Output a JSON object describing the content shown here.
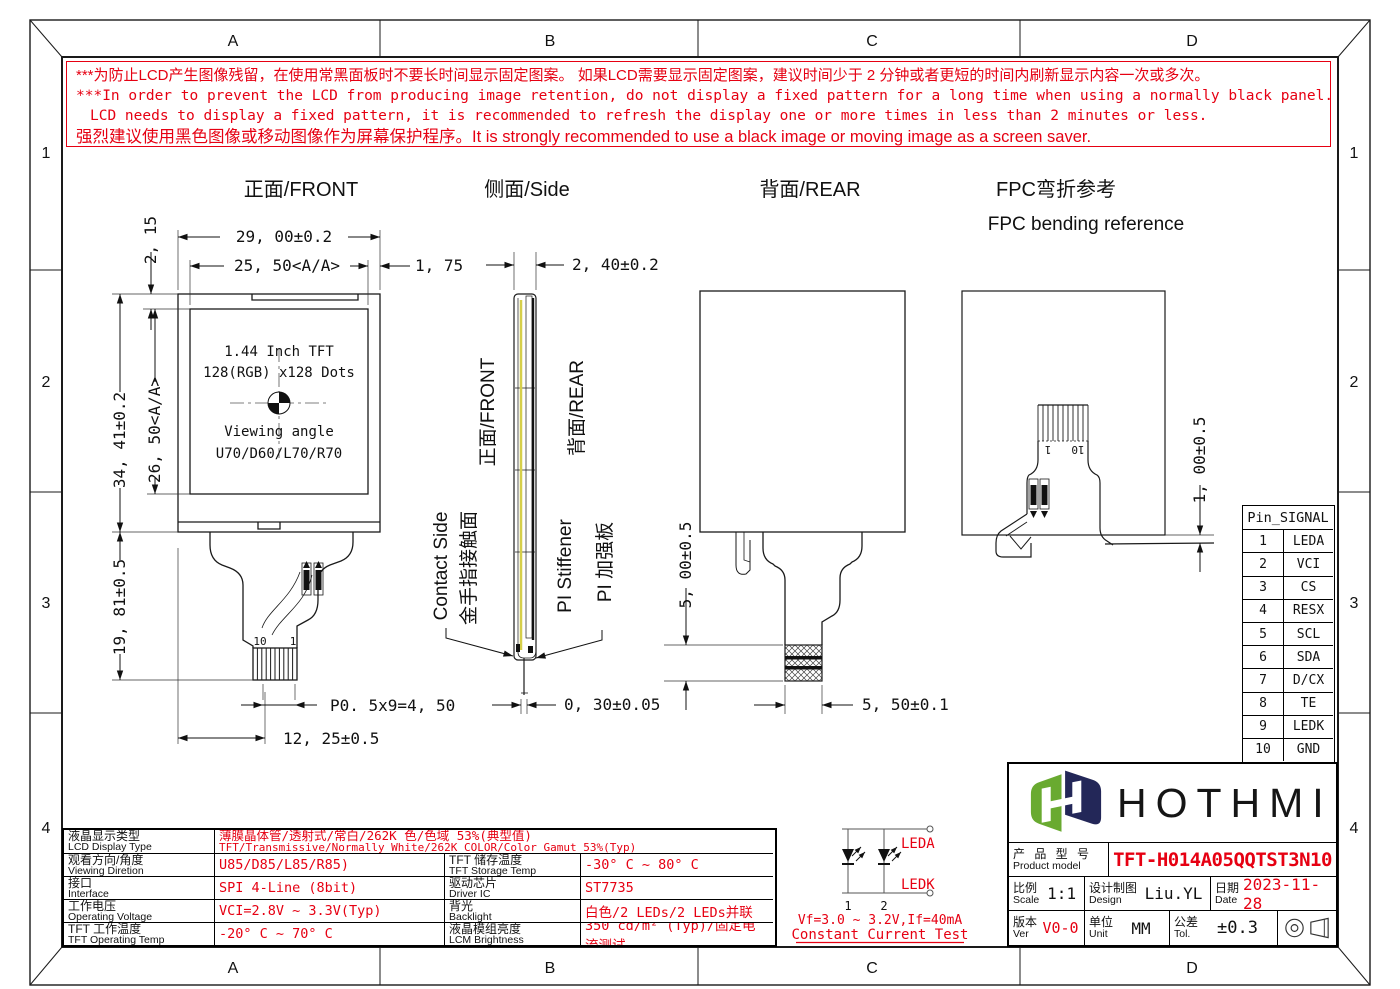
{
  "colors": {
    "accent_red": "#e60012",
    "film_yellow": "#d6cf4a",
    "logo_green": "#69aa30",
    "logo_navy": "#232758"
  },
  "sheet": {
    "cols": [
      "A",
      "B",
      "C",
      "D"
    ],
    "rows": [
      "1",
      "2",
      "3",
      "4"
    ]
  },
  "warning": {
    "line1": "***为防止LCD产生图像残留，在使用常黑面板时不要长时间显示固定图案。 如果LCD需要显示固定图案，建议时间少于 2 分钟或者更短的时间内刷新显示内容一次或多次。",
    "line2": "***In order to prevent the LCD from producing image retention, do not display a fixed pattern for a long time when using a normally black panel.If the",
    "line3": "LCD needs to display a fixed pattern, it is recommended to refresh the display one or more times in less than 2 minutes or less.",
    "line4": "强烈建议使用黑色图像或移动图像作为屏幕保护程序。It is strongly recommended to use a black image or moving image as a screen saver."
  },
  "front": {
    "title": "正面/FRONT",
    "dim_w": "29, 00±0.2",
    "dim_aa_w": "25, 50<A/A>",
    "dim_right": "1, 75",
    "dim_top": "2, 15",
    "dim_h": "34, 41±0.2",
    "dim_aa_h": "26, 50<A/A>",
    "dim_tail": "19, 81±0.5",
    "dim_pitch": "P0. 5x9=4, 50",
    "dim_fpc_w": "12, 25±0.5",
    "pin10": "10",
    "pin1": "1",
    "line1": "1.44 Inch TFT",
    "line2": "128(RGB) x128 Dots",
    "line3": "Viewing angle",
    "line4": "U70/D60/L70/R70"
  },
  "side": {
    "title": "侧面/Side",
    "dim_t": "2, 40±0.2",
    "front_label": "正面/FRONT",
    "rear_label": "背面/REAR",
    "contact_en": "Contact Side",
    "contact_cn": "金手指接触面",
    "stiff_en": "PI Stiffener",
    "stiff_cn": "PI 加强板",
    "dim_fpc_t": "0, 30±0.05"
  },
  "rear": {
    "title": "背面/REAR",
    "dim_pad_h": "5, 00±0.5",
    "dim_pad_w": "5, 50±0.1"
  },
  "bend": {
    "title_cn": "FPC弯折参考",
    "title_en": "FPC bending reference",
    "dim_gap": "1, 00±0.5",
    "pin1": "1",
    "pin10": "10"
  },
  "pin_table": {
    "header": "Pin_SIGNAL",
    "rows": [
      {
        "pin": "1",
        "signal": "LEDA"
      },
      {
        "pin": "2",
        "signal": "VCI"
      },
      {
        "pin": "3",
        "signal": "CS"
      },
      {
        "pin": "4",
        "signal": "RESX"
      },
      {
        "pin": "5",
        "signal": "SCL"
      },
      {
        "pin": "6",
        "signal": "SDA"
      },
      {
        "pin": "7",
        "signal": "D/CX"
      },
      {
        "pin": "8",
        "signal": "TE"
      },
      {
        "pin": "9",
        "signal": "LEDK"
      },
      {
        "pin": "10",
        "signal": "GND"
      }
    ]
  },
  "spec_table": {
    "rows": [
      {
        "label_cn": "液晶显示类型",
        "label_en": "LCD Display Type",
        "value_cn": "薄膜晶体管/透射式/常白/262K 色/色域 53%(典型值)",
        "value_en": "TFT/Transmissive/Normally White/262K COLOR/Color Gamut 53%(Typ)"
      },
      {
        "label_cn": "观看方向/角度",
        "label_en": "Viewing Diretion",
        "value": "U85/D85/L85/R85)",
        "label2_cn": "TFT 储存温度",
        "label2_en": "TFT Storage Temp",
        "value2": "-30° C ~ 80° C"
      },
      {
        "label_cn": "接口",
        "label_en": "Interface",
        "value": "SPI 4-Line (8bit)",
        "label2_cn": "驱动芯片",
        "label2_en": "Driver IC",
        "value2": "ST7735"
      },
      {
        "label_cn": "工作电压",
        "label_en": "Operating Voltage",
        "value": "VCI=2.8V ~ 3.3V(Typ)",
        "label2_cn": "背光",
        "label2_en": "Backlight",
        "value2": "白色/2 LEDs/2 LEDs并联"
      },
      {
        "label_cn": "TFT 工作温度",
        "label_en": "TFT Operating Temp",
        "value": "-20° C ~ 70° C",
        "label2_cn": "液晶模组亮度",
        "label2_en": "LCM Brightness",
        "value2": "350 cd/m² (Typ)/固定电流测试"
      }
    ]
  },
  "led_circuit": {
    "leda": "LEDA",
    "ledk": "LEDK",
    "n1": "1",
    "n2": "2",
    "vf": "Vf=3.0 ~ 3.2V,If=40mA",
    "test": "Constant Current Test"
  },
  "title_block": {
    "brand": "HOTHMI",
    "model_cn": "产 品 型 号",
    "model_en": "Product model",
    "model": "TFT-H014A05QQTST3N10",
    "scale_cn": "比例",
    "scale_en": "Scale",
    "scale": "1:1",
    "design_cn": "设计制图",
    "design_en": "Design",
    "designer": "Liu.YL",
    "date_cn": "日期",
    "date_en": "Date",
    "date": "2023-11-28",
    "ver_cn": "版本",
    "ver_en": "Ver",
    "ver": "V0-0",
    "unit_cn": "单位",
    "unit_en": "Unit",
    "unit": "MM",
    "tol_cn": "公差",
    "tol_en": "Tol.",
    "tol": "±0.3"
  }
}
